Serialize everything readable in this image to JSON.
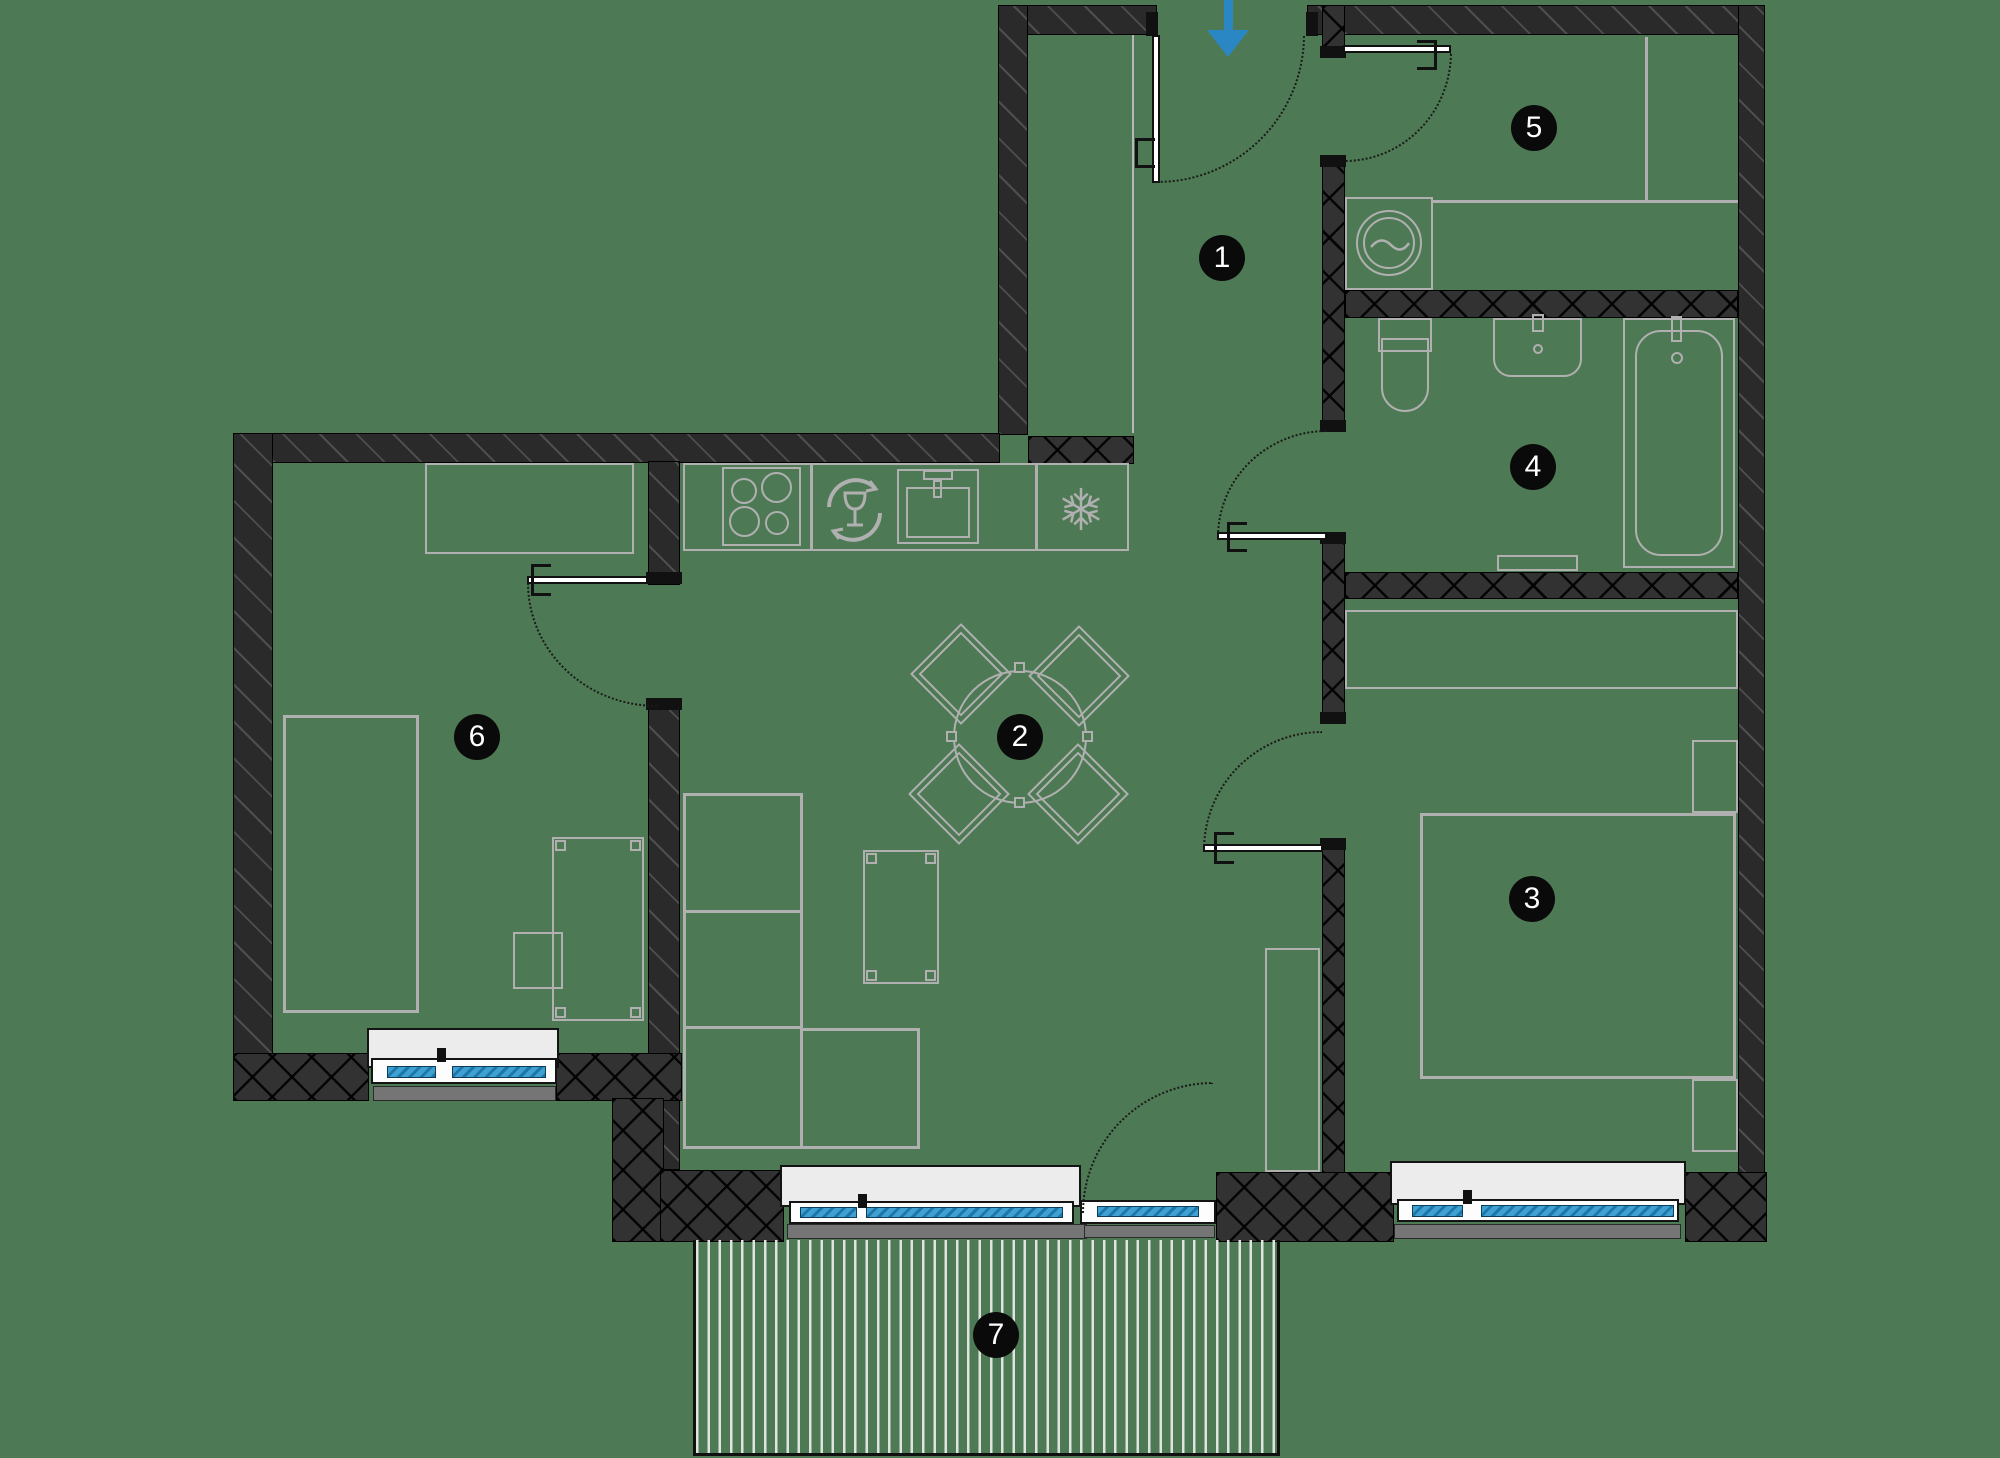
{
  "plan": {
    "rooms": [
      {
        "number": "1"
      },
      {
        "number": "2"
      },
      {
        "number": "3"
      },
      {
        "number": "4"
      },
      {
        "number": "5"
      },
      {
        "number": "6"
      },
      {
        "number": "7"
      }
    ],
    "entrance": {
      "symbol": "down-arrow"
    },
    "colors": {
      "background": "#4d7a54",
      "wall": "#2a2a2a",
      "entrance_arrow": "#2b87c3",
      "window_glazing": "#2f95cd",
      "furniture_line": "#b0b0b0",
      "window_sill": "#ececec",
      "outer_sill": "#757575",
      "badge": "#0a0a0a"
    },
    "icons": {
      "kitchen": [
        "hob",
        "dishwasher",
        "sink",
        "fridge-snowflake"
      ],
      "utility": [
        "washing-machine"
      ],
      "bathroom": [
        "toilet",
        "basin",
        "bathtub"
      ]
    }
  }
}
